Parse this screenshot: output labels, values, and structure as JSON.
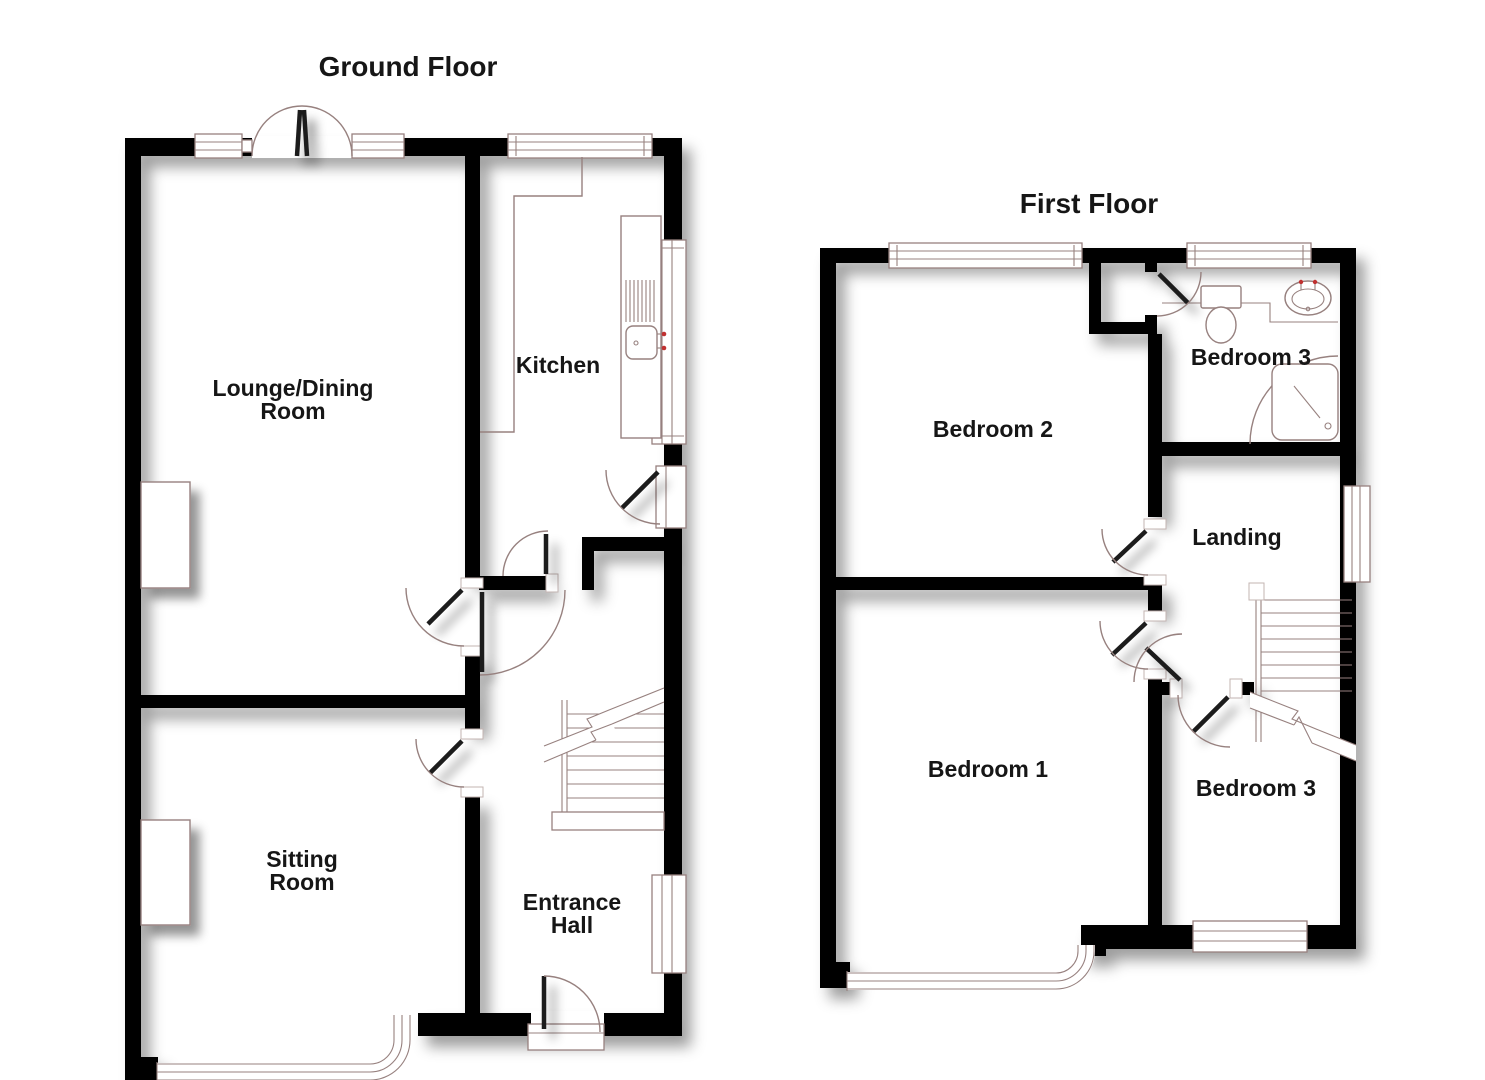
{
  "page": {
    "background": "#ffffff"
  },
  "colors": {
    "wall": "#050505",
    "thin_line": "#97817f",
    "label_text": "#161616",
    "jamb_outline": "#c3b4b2",
    "tap_accent": "#c03030",
    "background": "#ffffff"
  },
  "ground_floor": {
    "title": "Ground Floor",
    "rooms": {
      "lounge_dining": {
        "line1": "Lounge/Dining",
        "line2": "Room"
      },
      "kitchen": {
        "label": "Kitchen"
      },
      "sitting": {
        "line1": "Sitting",
        "line2": "Room"
      },
      "entrance_hall": {
        "line1": "Entrance",
        "line2": "Hall"
      }
    }
  },
  "first_floor": {
    "title": "First Floor",
    "rooms": {
      "bedroom2": {
        "label": "Bedroom 2"
      },
      "bathroom": {
        "label": "Bedroom 3"
      },
      "landing": {
        "label": "Landing"
      },
      "bedroom1": {
        "label": "Bedroom 1"
      },
      "bedroom3": {
        "label": "Bedroom 3"
      }
    }
  }
}
